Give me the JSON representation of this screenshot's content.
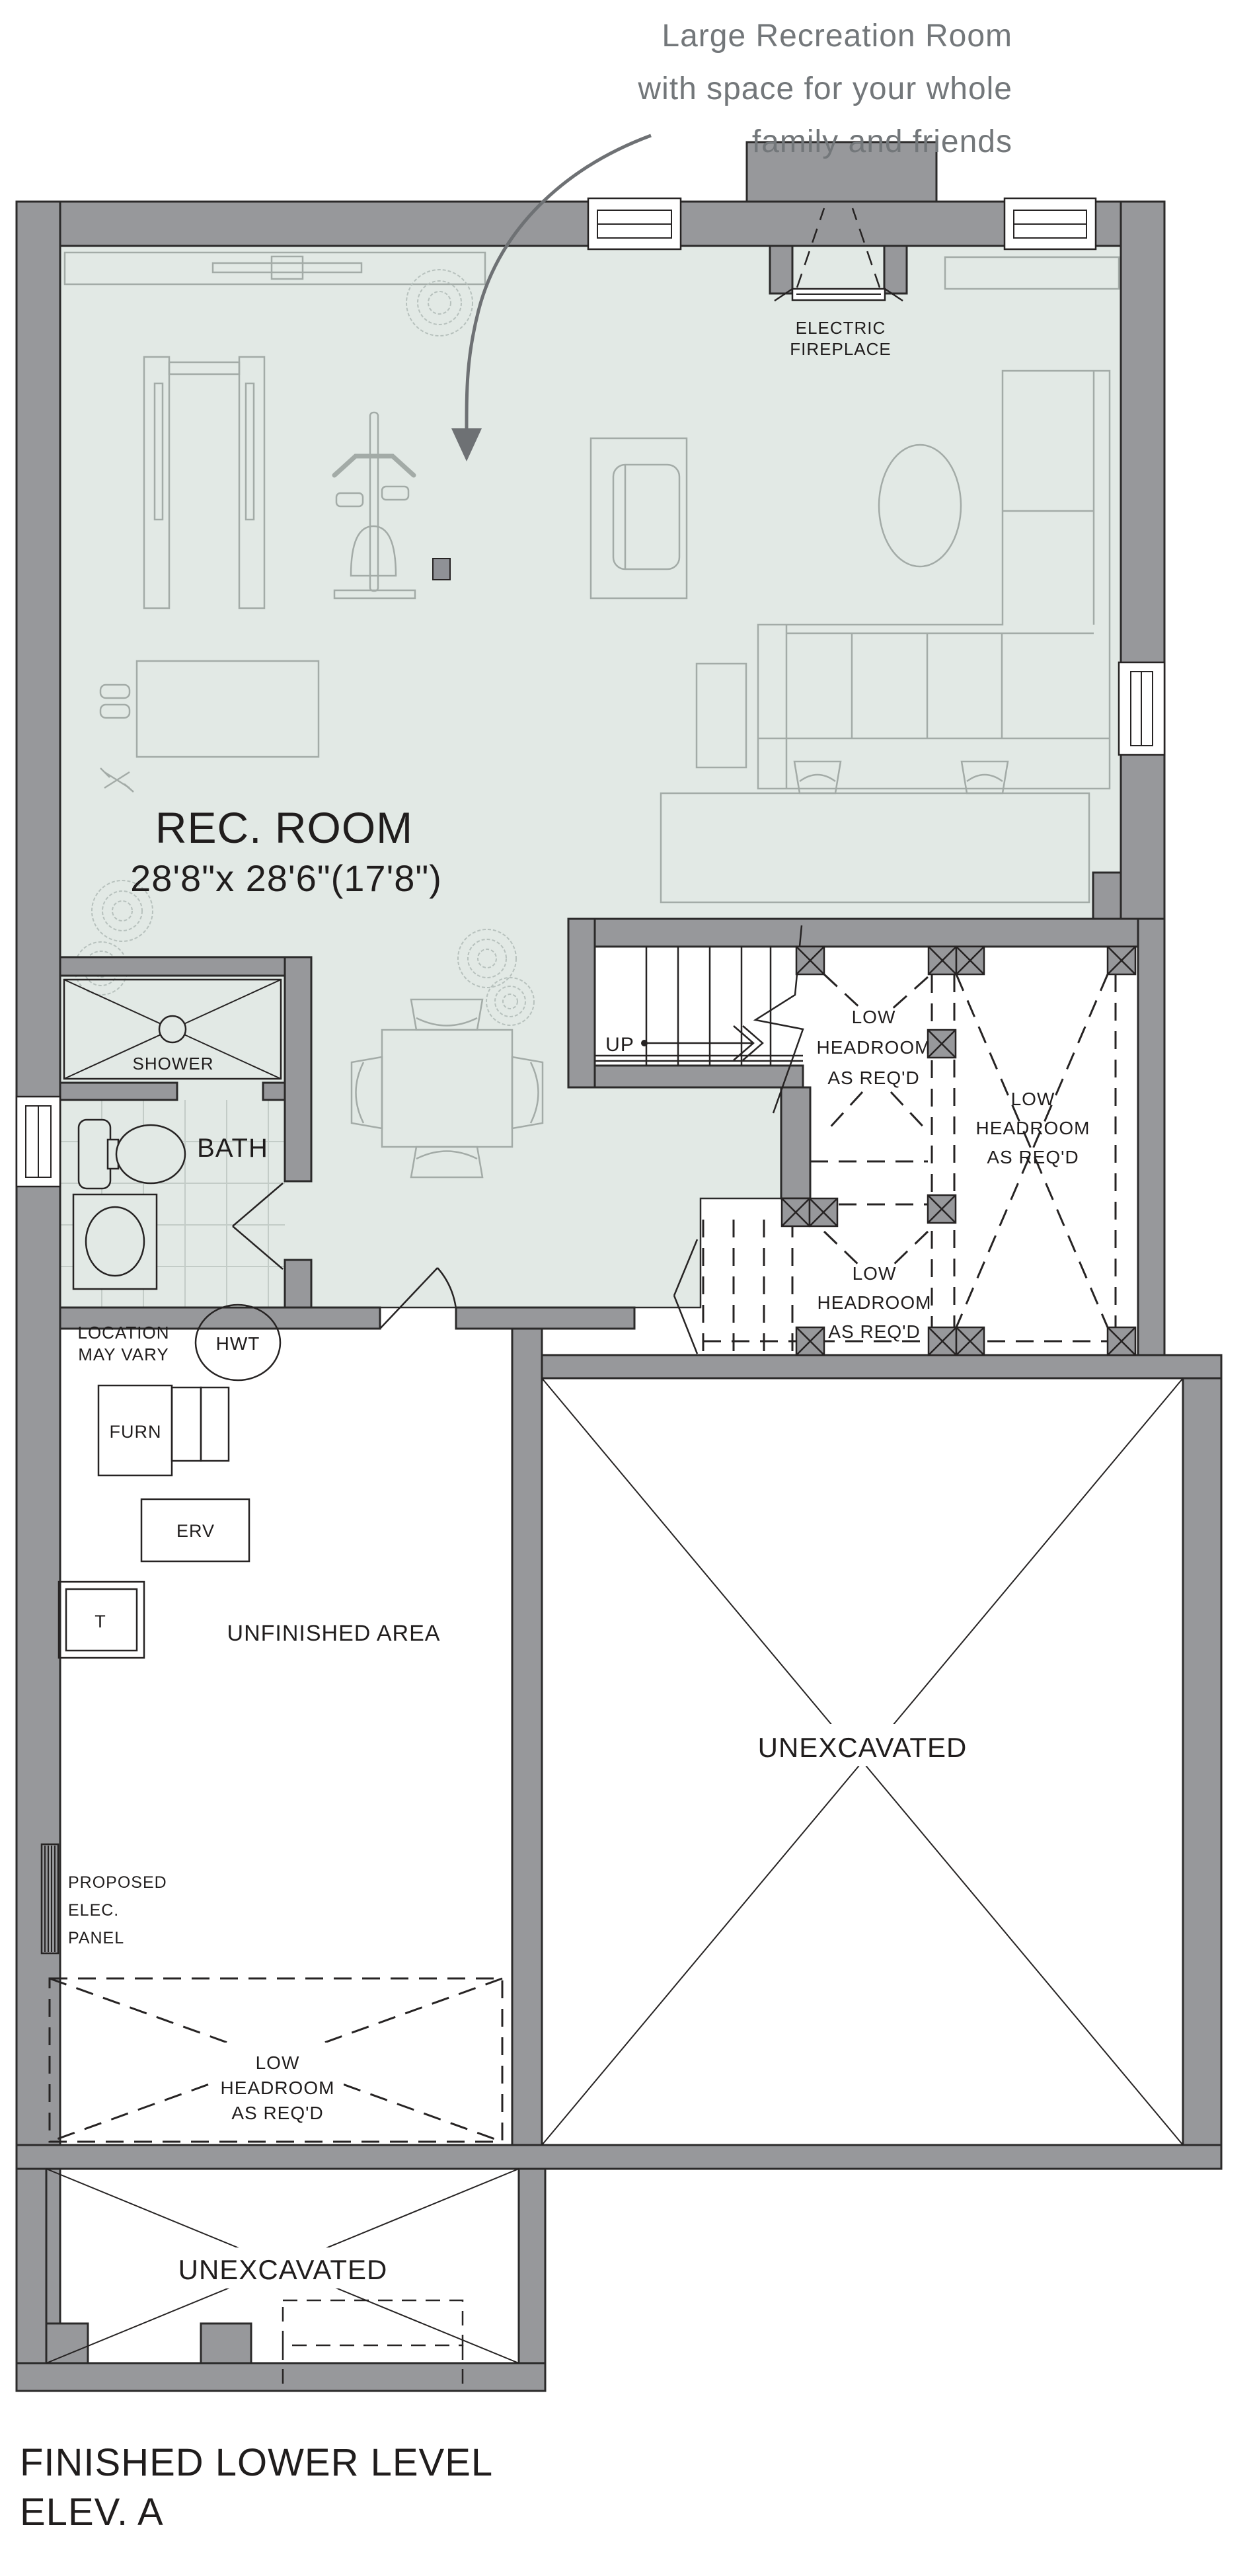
{
  "annotation": {
    "line1": "Large Recreation Room",
    "line2": "with space for your whole",
    "line3": "family and friends"
  },
  "fireplace": {
    "line1": "ELECTRIC",
    "line2": "FIREPLACE"
  },
  "rec_room": {
    "name": "REC. ROOM",
    "dims": "28'8\"x 28'6\"(17'8\")"
  },
  "shower": "SHOWER",
  "bath": "BATH",
  "stairs": {
    "up": "UP"
  },
  "low_headroom": {
    "line1": "LOW",
    "line2": "HEADROOM",
    "line3": "AS REQ'D"
  },
  "location_note": {
    "line1": "LOCATION",
    "line2": "MAY VARY"
  },
  "equipment": {
    "hwt": "HWT",
    "furn": "FURN",
    "erv": "ERV",
    "t": "T"
  },
  "unfinished_area": "UNFINISHED AREA",
  "elec_panel": {
    "line1": "PROPOSED",
    "line2": "ELEC.",
    "line3": "PANEL"
  },
  "unexcavated_right": "UNEXCAVATED",
  "unexcavated_bottom": "UNEXCAVATED",
  "title": {
    "line1": "FINISHED LOWER LEVEL",
    "line2": "ELEV. A"
  },
  "colors": {
    "wall_gray": "#97989b",
    "floor_green": "#e2e9e5",
    "line_black": "#262323",
    "annotation_gray": "#73777a",
    "furniture_gray": "#a3aba7"
  }
}
